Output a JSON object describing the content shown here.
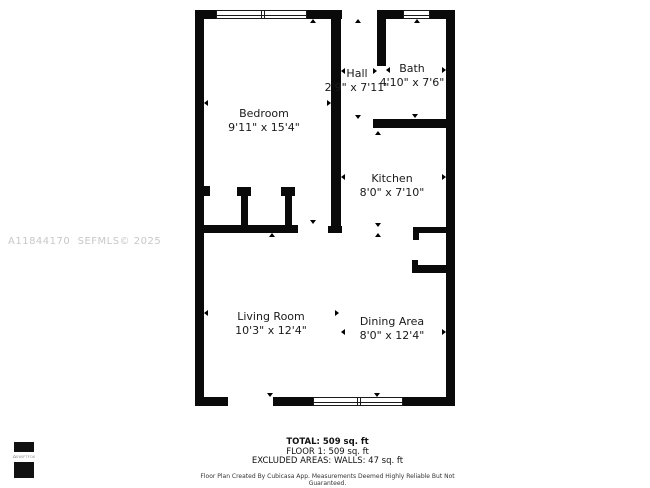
{
  "watermark": {
    "text": "A11844170  SEFMLS© 2025"
  },
  "logo": {
    "text": "SWIFTFOX",
    "icon": "house-icon"
  },
  "rooms": [
    {
      "id": "bedroom",
      "name": "Bedroom",
      "dims": "9'11\" x 15'4\""
    },
    {
      "id": "hall",
      "name": "Hall",
      "dims": "2'9\" x 7'11\""
    },
    {
      "id": "bath",
      "name": "Bath",
      "dims": "4'10\" x 7'6\""
    },
    {
      "id": "kitchen",
      "name": "Kitchen",
      "dims": "8'0\" x 7'10\""
    },
    {
      "id": "living_room",
      "name": "Living Room",
      "dims": "10'3\" x 12'4\""
    },
    {
      "id": "dining_area",
      "name": "Dining Area",
      "dims": "8'0\" x 12'4\""
    }
  ],
  "summary": {
    "total": "TOTAL: 509 sq. ft",
    "floor1": "FLOOR 1: 509 sq. ft",
    "excluded": "EXCLUDED AREAS: WALLS: 47 sq. ft",
    "disclaimer": "Floor Plan Created By Cubicasa App. Measurements Deemed Highly Reliable But Not Guaranteed."
  },
  "colors": {
    "wall": "#0a0a0a",
    "label_text": "#1a1a1a",
    "watermark_text": "#c8c8c8"
  }
}
